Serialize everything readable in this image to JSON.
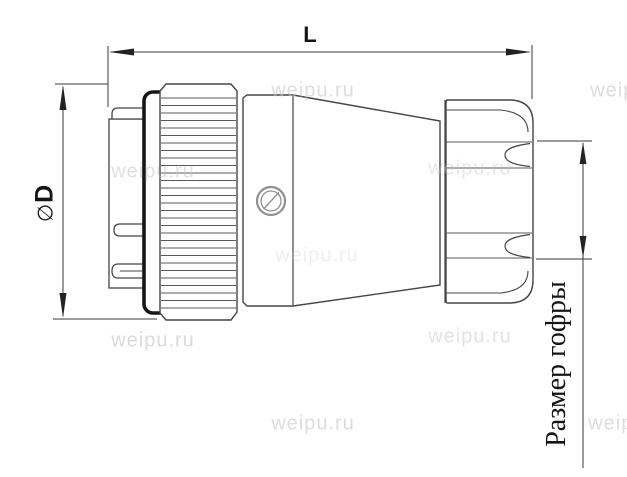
{
  "drawing": {
    "title": "circular cable connector side view technical drawing",
    "dimensions": {
      "length_label": "L",
      "diameter_symbol": "∅",
      "diameter_letter": "D",
      "corrugation_label": "Размер гофры"
    },
    "watermark": {
      "text": "weipu.ru"
    },
    "colors": {
      "line": "#454545",
      "seal_outline": "#161616",
      "dimension_line": "#3a3a3a",
      "screw_detail": "#8f8f8f",
      "watermark": "#c2c2c2",
      "background": "#ffffff"
    }
  }
}
